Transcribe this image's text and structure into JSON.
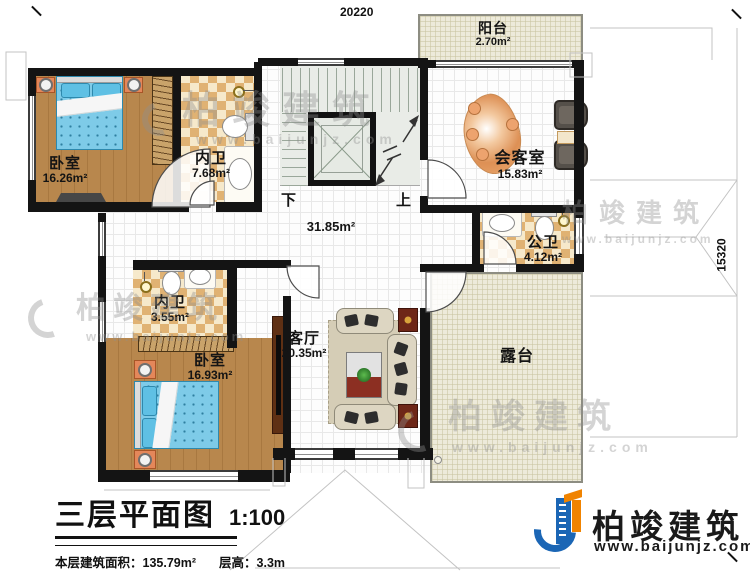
{
  "dimensions": {
    "top_width": "20220",
    "right_height": "15320"
  },
  "rooms": [
    {
      "name": "卧室",
      "area": "16.26m²"
    },
    {
      "name": "内卫",
      "area": "7.68m²"
    },
    {
      "name": "",
      "area": "31.85m²"
    },
    {
      "name": "阳台",
      "area": "2.70m²"
    },
    {
      "name": "会客室",
      "area": "15.83m²"
    },
    {
      "name": "公卫",
      "area": "4.12m²"
    },
    {
      "name": "内卫",
      "area": "3.55m²"
    },
    {
      "name": "卧室",
      "area": "16.93m²"
    },
    {
      "name": "客厅",
      "area": "20.35m²"
    },
    {
      "name": "露台",
      "area": ""
    }
  ],
  "stairs": {
    "down_label": "下",
    "up_label": "上"
  },
  "title_block": {
    "title": "三层平面图",
    "scale": "1:100",
    "area_label": "本层建筑面积：",
    "area_value": "135.79m²",
    "height_label": "层高：",
    "height_value": "3.3m"
  },
  "brand": {
    "name": "柏竣建筑",
    "website": "www.baijunjz.com"
  }
}
